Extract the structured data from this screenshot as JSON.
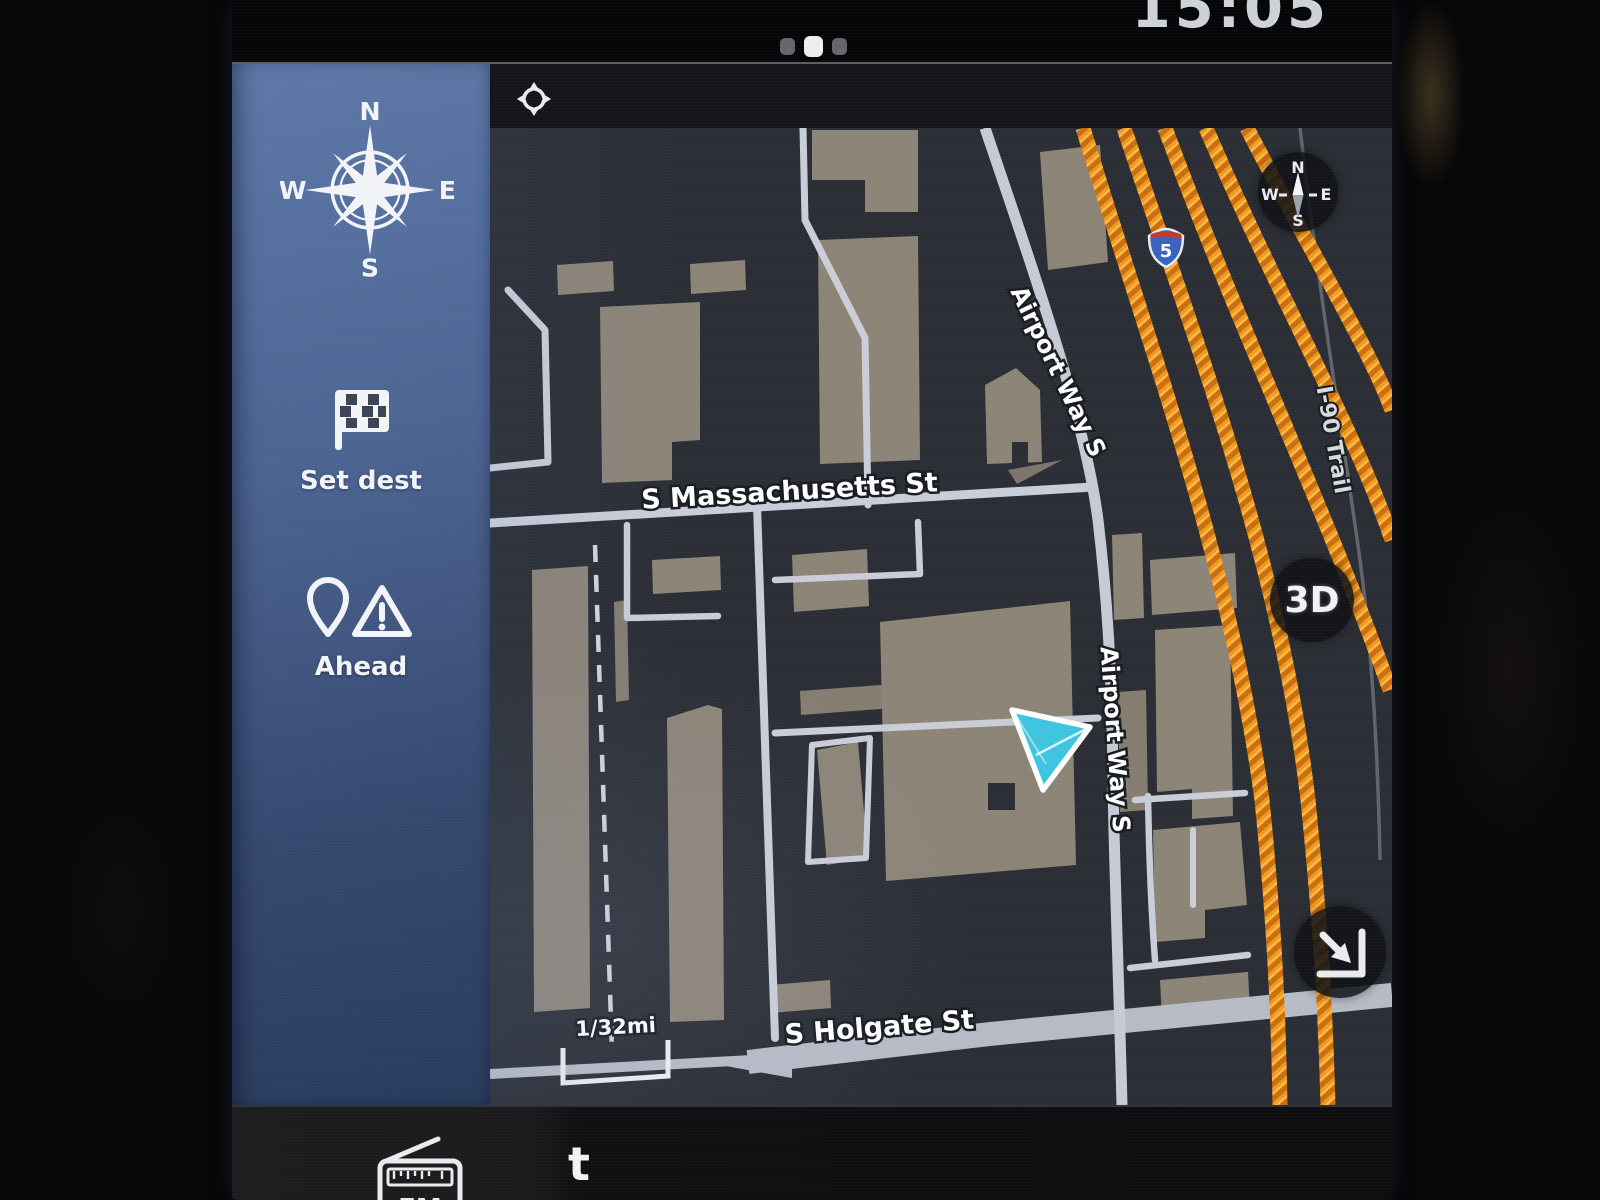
{
  "status_bar": {
    "clock": "15:05"
  },
  "compass": {
    "n": "N",
    "e": "E",
    "s": "S",
    "w": "W"
  },
  "sidebar": {
    "set_dest_label": "Set dest",
    "ahead_label": "Ahead"
  },
  "map": {
    "streets": {
      "massachusetts": "S Massachusetts St",
      "holgate": "S Holgate St",
      "airport_way_1": "Airport Way S",
      "airport_way_2": "Airport Way S",
      "i90_trail": "I-90 Trail"
    },
    "shield_route": "5",
    "scale": "1/32mi",
    "view_button": "3D",
    "colors": {
      "highway_traffic": "#ef9420",
      "road": "#c9cdd8",
      "building": "#8d8478",
      "map_background": "#2b2e35",
      "vehicle_marker": "#3fc4e0",
      "sidebar_top": "#5d79a9",
      "sidebar_bottom": "#293c5e"
    }
  },
  "bottom_bar": {
    "fm_label": "FM",
    "track_text": "t"
  }
}
